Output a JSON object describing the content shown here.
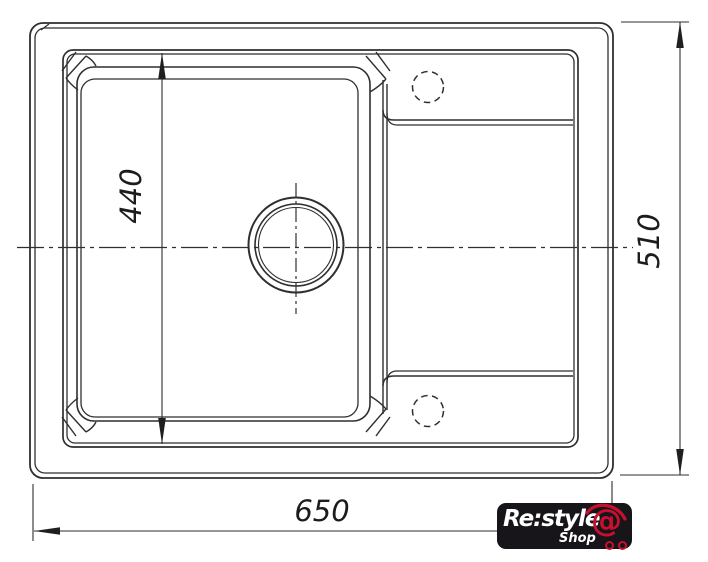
{
  "drawing": {
    "title": "sink-top-view-technical-drawing",
    "dimensions": {
      "overall_width_mm": "650",
      "overall_depth_mm": "510",
      "bowl_depth_mm": "440"
    },
    "features": {
      "drain": "concentric-drain-circles",
      "tap_holes": "two-dashed-tap-hole-circles",
      "centerlines": "dash-dot"
    },
    "colors": {
      "line": "#2f2f2f",
      "background": "#ffffff"
    }
  },
  "logo": {
    "brand": "Re:style",
    "sub": "Shop",
    "at": "@",
    "background": "#17141a",
    "accent": "#c8102e",
    "text_color": "#ffffff"
  }
}
